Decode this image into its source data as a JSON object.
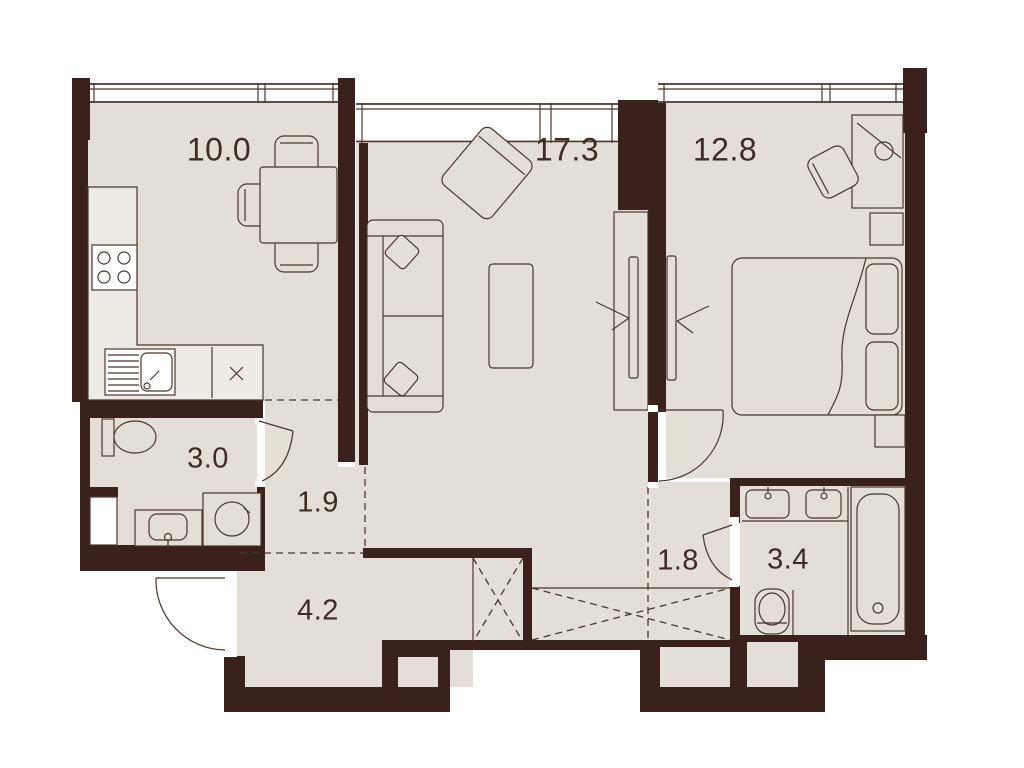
{
  "plan": {
    "type": "apartment-floor-plan",
    "rooms": {
      "kitchen": {
        "label": "kitchen-dining",
        "area": "10.0"
      },
      "living": {
        "label": "living-room",
        "area": "17.3"
      },
      "bedroom": {
        "label": "bedroom",
        "area": "12.8"
      },
      "bathroom_small": {
        "label": "wc-laundry",
        "area": "3.0"
      },
      "hall": {
        "label": "inner-hall",
        "area": "1.9"
      },
      "entry": {
        "label": "entry-hall",
        "area": "4.2"
      },
      "corridor": {
        "label": "corridor",
        "area": "1.8"
      },
      "bathroom_main": {
        "label": "bathroom",
        "area": "3.4"
      }
    }
  },
  "colors": {
    "wall": "#3b211b",
    "floor": "#e3dfd7",
    "counter": "#edeae3",
    "window": "#ffffff",
    "line": "#4a362d",
    "label": "#3e2b23"
  }
}
